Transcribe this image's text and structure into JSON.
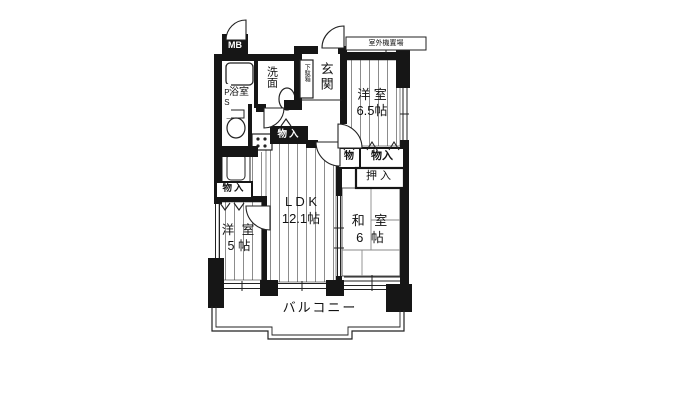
{
  "floorplan": {
    "rooms": {
      "ldk": {
        "name": "L D K",
        "size": "12.1帖"
      },
      "western_room_large": {
        "name": "洋 室",
        "size": "6.5帖"
      },
      "western_room_small": {
        "name": "洋 室",
        "size": "5 帖"
      },
      "japanese_room": {
        "name": "和 室",
        "size": "6 帖"
      },
      "bathroom": "浴室",
      "washroom": "洗面",
      "entrance": "玄関",
      "balcony": "バルコニー"
    },
    "storage": {
      "closet_hall": "物入",
      "closet_left": "物入",
      "closet_small": "物",
      "closet_right": "物入",
      "oshiire": "押入",
      "shoe_cabinet": "下駄箱"
    },
    "service": {
      "meter_box": "MB",
      "pipe_space": "PS",
      "outdoor_unit_area": "室外機置場"
    },
    "colors": {
      "wall": "#161616",
      "line": "#2b2b2b",
      "floor": "#ffffff"
    }
  }
}
